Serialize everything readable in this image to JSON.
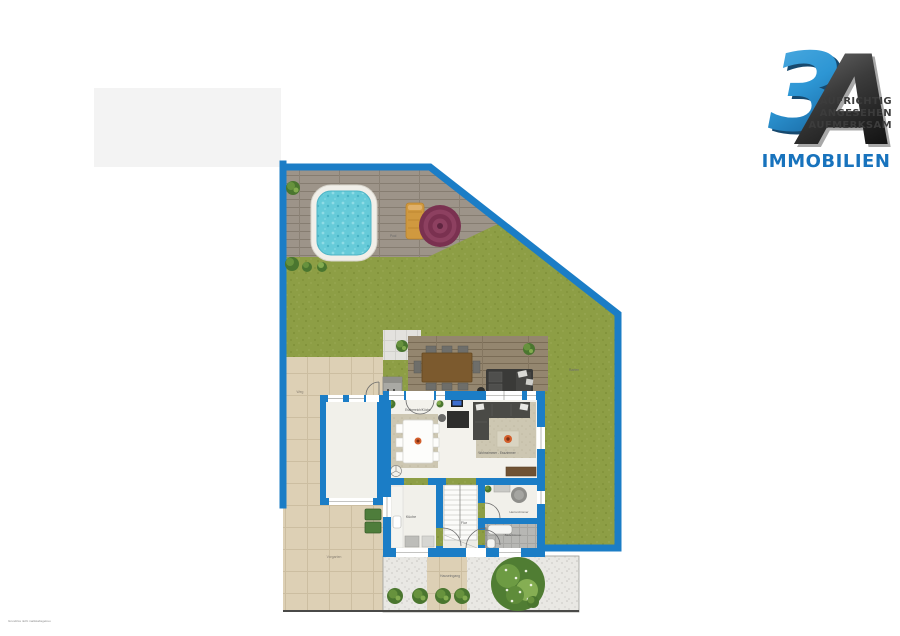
{
  "logo": {
    "number": "3",
    "letter": "A",
    "tagline": [
      "AUFRICHTIG",
      "ANGESEHEN",
      "AUFMERKSAM"
    ],
    "brand": "IMMOBILIEN",
    "colors": {
      "blue": "#2d96d4",
      "dark": "#2b2b2b",
      "brand": "#1873bd"
    }
  },
  "plan": {
    "labels": {
      "pool": "Pool",
      "garten": "Garten",
      "weg": "Weg",
      "vorgarten": "Vorgarten",
      "hauseingang": "Hauseingang",
      "essbereich": "Essbereich/Küche",
      "wohnzimmer": "Wohnzimmer - Esszimmer",
      "kueche": "Küche",
      "flur": "Flur",
      "herrenzimmer": "Herrenzimmer",
      "badezimmer": "Badezimmer"
    },
    "disclaimer": "Grundriss nicht maßstabsgetreu",
    "colors": {
      "boundary": "#1b7dc6",
      "grass": "#8d9e45",
      "deck": "#9d9489",
      "terrace_wood": "#94866f",
      "paving": "#ddd0b5",
      "gravel": "#e9e8e4",
      "pool_water": "#66cbd9",
      "parasol": "#7a3150"
    }
  }
}
